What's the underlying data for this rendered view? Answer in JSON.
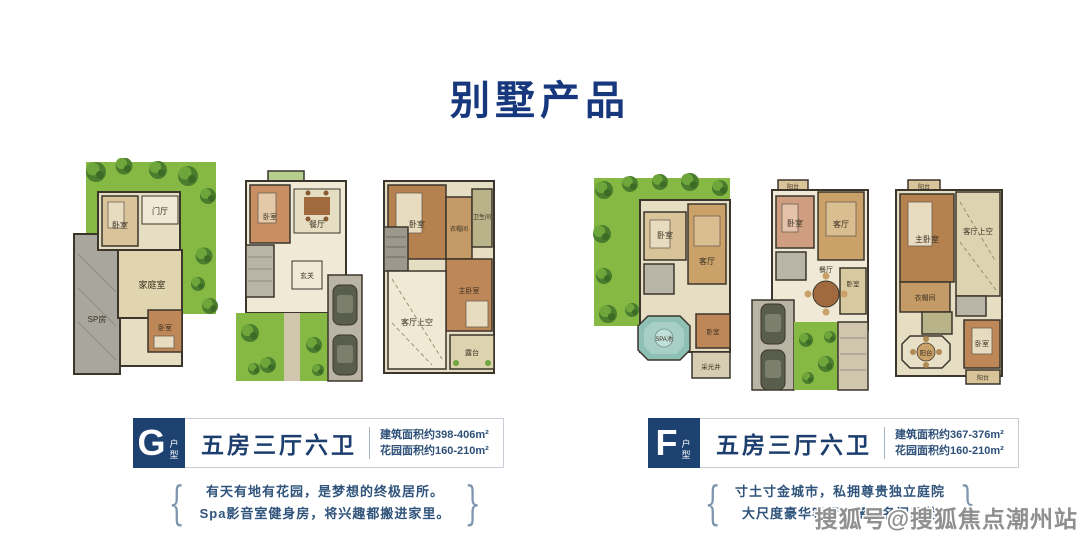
{
  "title": "别墅产品",
  "watermark": "搜狐号@搜狐焦点潮州站",
  "decor": {
    "bracket_left": "{",
    "bracket_right": "}"
  },
  "colors": {
    "title_blue": "#18387e",
    "badge_navy": "#1d4272",
    "headline_navy": "#1c3e6e",
    "body_navy": "#2e5078",
    "garden_green": "#85b944",
    "room_beige": "#e6dec3",
    "pool_teal": "#8fc0b5",
    "watermark_gray": "#8f8f8f"
  },
  "groups": [
    {
      "id": "G",
      "badge": {
        "letter": "G",
        "suffix": "户型"
      },
      "headline": "五房三厅六卫",
      "areas": [
        "建筑面积约398-406m²",
        "花园面积约160-210m²"
      ],
      "desc": [
        "有天有地有花园，是梦想的终极居所。",
        "Spa影音室健身房，将兴趣都搬进家里。"
      ],
      "plans": [
        {
          "labels": [
            "卧室",
            "门厅",
            "家庭室",
            "SP房",
            "卧室"
          ]
        },
        {
          "labels": [
            "卧室",
            "餐厅",
            "玄关"
          ]
        },
        {
          "labels": [
            "卧室",
            "卫生间",
            "衣帽间",
            "主卧室",
            "客厅上空",
            "露台"
          ]
        }
      ]
    },
    {
      "id": "F",
      "badge": {
        "letter": "F",
        "suffix": "户型"
      },
      "headline": "五房三厅六卫",
      "areas": [
        "建筑面积约367-376m²",
        "花园面积约160-210m²"
      ],
      "desc": [
        "寸土寸金城市，私拥尊贵独立庭院",
        "大尺度豪华客厅，涵养名门风范"
      ],
      "plans": [
        {
          "labels": [
            "卧室",
            "客厅",
            "SPA池",
            "卧室",
            "采光井"
          ]
        },
        {
          "labels": [
            "阳台",
            "卧室",
            "客厅",
            "餐厅",
            "卧室"
          ]
        },
        {
          "labels": [
            "阳台",
            "主卧室",
            "客厅上空",
            "衣帽间",
            "阳台",
            "卧室",
            "阳台"
          ]
        }
      ]
    }
  ]
}
